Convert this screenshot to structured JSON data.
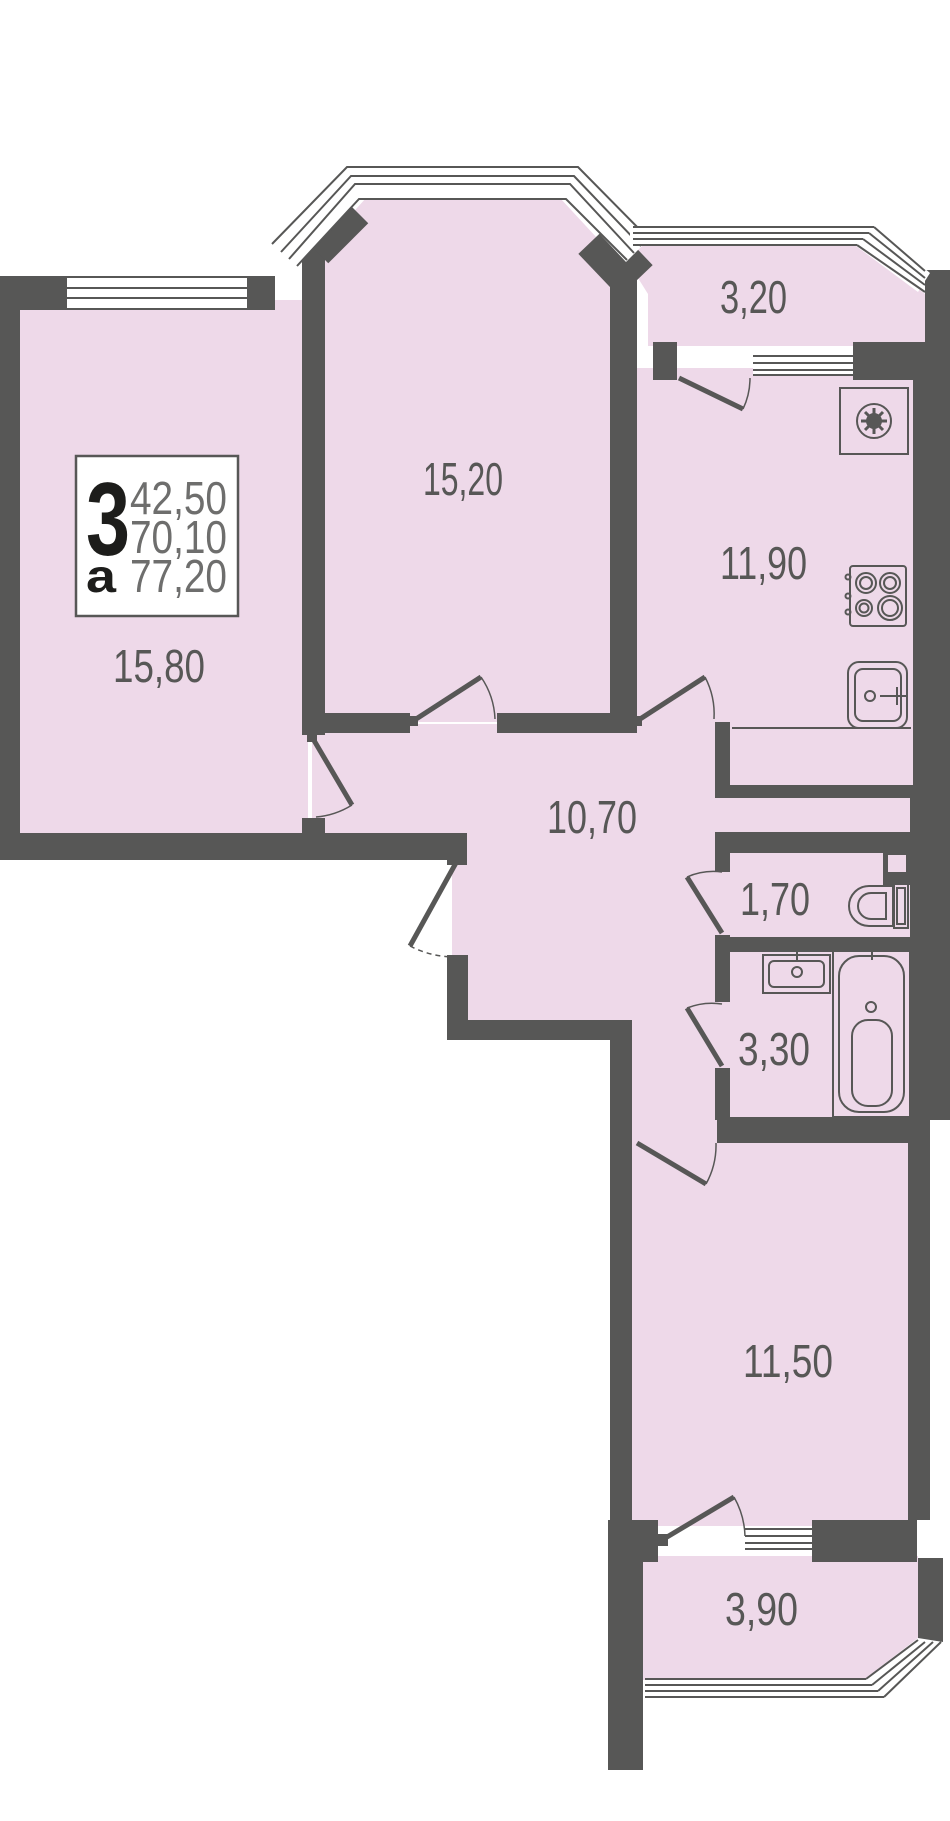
{
  "plan": {
    "title": "3-room apartment floor plan",
    "colors": {
      "wall": "#575756",
      "room_fill": "#eed9e9",
      "window_white": "#ffffff",
      "line": "#575756",
      "label_text": "#575756",
      "info_number_text": "#6e6e6d",
      "info_black_text": "#1d1d1b",
      "background": "#ffffff"
    },
    "info_box": {
      "rooms_count": "3",
      "type_letter": "а",
      "area_1": "42,50",
      "area_2": "70,10",
      "area_3": "77,20"
    },
    "rooms": [
      {
        "name": "balcony-top",
        "area_label": "3,20"
      },
      {
        "name": "living-room-top",
        "area_label": "15,20"
      },
      {
        "name": "kitchen",
        "area_label": "11,90"
      },
      {
        "name": "living-room-left",
        "area_label": "15,80"
      },
      {
        "name": "hallway",
        "area_label": "10,70"
      },
      {
        "name": "wc",
        "area_label": "1,70"
      },
      {
        "name": "bathroom",
        "area_label": "3,30"
      },
      {
        "name": "living-room-bottom",
        "area_label": "11,50"
      },
      {
        "name": "balcony-bottom",
        "area_label": "3,90"
      }
    ],
    "fixtures": [
      {
        "name": "washing-machine-icon"
      },
      {
        "name": "stove-icon"
      },
      {
        "name": "kitchen-sink-icon"
      },
      {
        "name": "toilet-icon"
      },
      {
        "name": "bath-sink-icon"
      },
      {
        "name": "bathtub-icon"
      }
    ]
  }
}
